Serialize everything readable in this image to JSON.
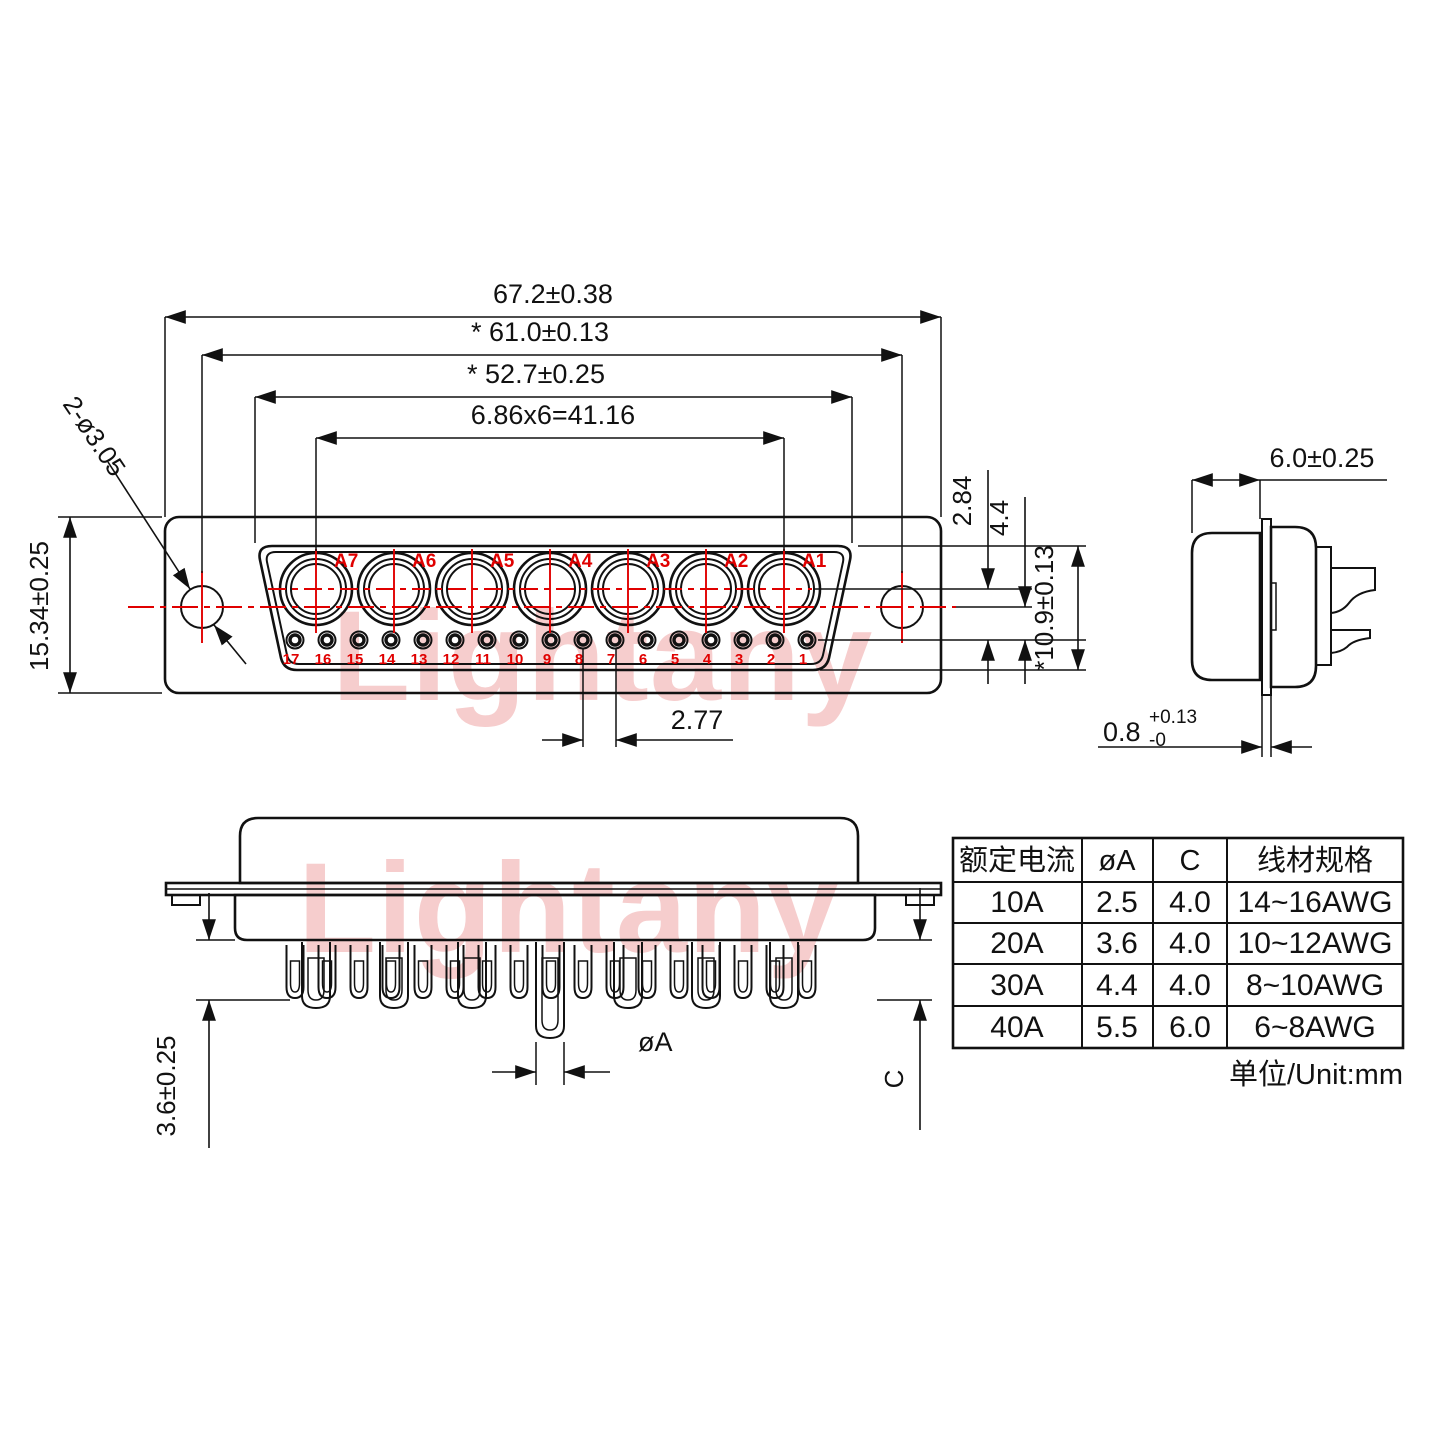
{
  "watermark": {
    "text": "Lightany"
  },
  "front_view": {
    "dims": {
      "outer_width": "67.2±0.38",
      "mount_pitch": "* 61.0±0.13",
      "shell_width": "* 52.7±0.25",
      "contact_pitch": "6.86x6=41.16",
      "mount_hole_callout": "2-ø3.05",
      "overall_height": "15.34±0.25",
      "row_offset_1": "2.84",
      "row_offset_2": "4.4",
      "shell_height": "*10.9±0.13",
      "hole_pitch": "2.77"
    },
    "contact_labels": [
      "A7",
      "A6",
      "A5",
      "A4",
      "A3",
      "A2",
      "A1"
    ],
    "hole_numbers": [
      "17",
      "16",
      "15",
      "14",
      "13",
      "12",
      "11",
      "10",
      "9",
      "8",
      "7",
      "6",
      "5",
      "4",
      "3",
      "2",
      "1"
    ]
  },
  "side_view": {
    "dims": {
      "shell_depth": "6.0±0.25",
      "flange_thickness": "0.8",
      "flange_tol_plus": "+0.13",
      "flange_tol_minus": "-0"
    }
  },
  "bottom_view": {
    "dims": {
      "pin_length": "3.6±0.25",
      "pin_diameter": "øA",
      "cup_depth": "C"
    }
  },
  "spec_table": {
    "headers": [
      "额定电流",
      "øA",
      "C",
      "线材规格"
    ],
    "rows": [
      [
        "10A",
        "2.5",
        "4.0",
        "14~16AWG"
      ],
      [
        "20A",
        "3.6",
        "4.0",
        "10~12AWG"
      ],
      [
        "30A",
        "4.4",
        "4.0",
        "8~10AWG"
      ],
      [
        "40A",
        "5.5",
        "6.0",
        "6~8AWG"
      ]
    ],
    "unit": "单位/Unit:mm"
  }
}
